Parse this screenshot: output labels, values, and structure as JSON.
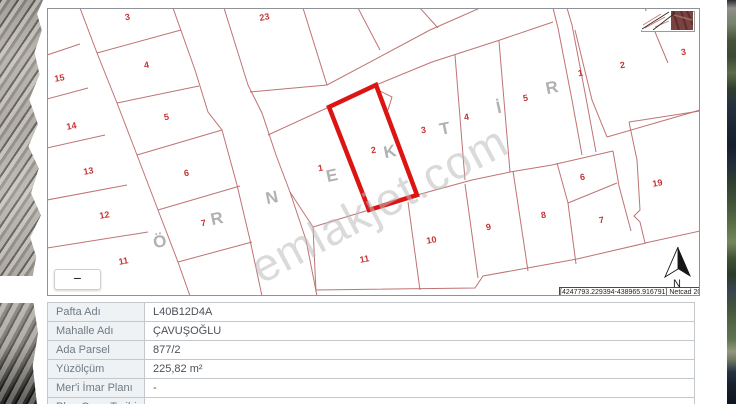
{
  "map": {
    "colors": {
      "line": "#bc6b6b",
      "highlight": "#dd1414",
      "number": "#c53535",
      "letter": "#b1b1b1",
      "frame": "#8f9397",
      "watermark": "#bcbcbc"
    },
    "watermark": "emlakjet.com",
    "zoom_out_button": "−",
    "north_label": "N",
    "credit": "[4247793.229394-438965.916791] Netcad 2025",
    "sample_letters": [
      {
        "t": "Ö",
        "x": 161,
        "y": 241
      },
      {
        "t": "R",
        "x": 218,
        "y": 218
      },
      {
        "t": "N",
        "x": 273,
        "y": 197
      },
      {
        "t": "E",
        "x": 333,
        "y": 175
      },
      {
        "t": "K",
        "x": 391,
        "y": 151
      },
      {
        "t": "T",
        "x": 446,
        "y": 128
      },
      {
        "t": "İ",
        "x": 500,
        "y": 107
      },
      {
        "t": "R",
        "x": 553,
        "y": 87
      }
    ],
    "parcel_labels": [
      {
        "t": "3",
        "x": 128,
        "y": 17
      },
      {
        "t": "23",
        "x": 265,
        "y": 17
      },
      {
        "t": "15",
        "x": 60,
        "y": 78
      },
      {
        "t": "4",
        "x": 147,
        "y": 65
      },
      {
        "t": "14",
        "x": 72,
        "y": 126
      },
      {
        "t": "5",
        "x": 167,
        "y": 117
      },
      {
        "t": "13",
        "x": 89,
        "y": 171
      },
      {
        "t": "6",
        "x": 187,
        "y": 173
      },
      {
        "t": "12",
        "x": 105,
        "y": 215
      },
      {
        "t": "7",
        "x": 204,
        "y": 223
      },
      {
        "t": "11",
        "x": 124,
        "y": 261
      },
      {
        "t": "1",
        "x": 321,
        "y": 168
      },
      {
        "t": "3",
        "x": 424,
        "y": 130
      },
      {
        "t": "4",
        "x": 467,
        "y": 117
      },
      {
        "t": "5",
        "x": 526,
        "y": 98
      },
      {
        "t": "11",
        "x": 365,
        "y": 259
      },
      {
        "t": "10",
        "x": 432,
        "y": 240
      },
      {
        "t": "9",
        "x": 489,
        "y": 227
      },
      {
        "t": "8",
        "x": 544,
        "y": 215
      },
      {
        "t": "6",
        "x": 583,
        "y": 177
      },
      {
        "t": "7",
        "x": 602,
        "y": 220
      },
      {
        "t": "1",
        "x": 581,
        "y": 73
      },
      {
        "t": "2",
        "x": 623,
        "y": 65
      },
      {
        "t": "3",
        "x": 684,
        "y": 52
      },
      {
        "t": "19",
        "x": 658,
        "y": 183
      }
    ],
    "highlighted_parcel": {
      "label": "2",
      "x": 374,
      "y": 150,
      "points": "329,107 376,85 417,195 369,210"
    }
  },
  "details_table": {
    "rows": [
      {
        "label": "Pafta Adı",
        "value": "L40B12D4A"
      },
      {
        "label": "Mahalle Adı",
        "value": "ÇAVUŞOĞLU"
      },
      {
        "label": "Ada Parsel",
        "value": "877/2"
      },
      {
        "label": "Yüzölçüm",
        "value": "225,82 m²"
      },
      {
        "label": "Mer'i İmar Planı",
        "value": "-"
      },
      {
        "label": "Plan Onay Tarihi",
        "value": "-"
      }
    ]
  }
}
